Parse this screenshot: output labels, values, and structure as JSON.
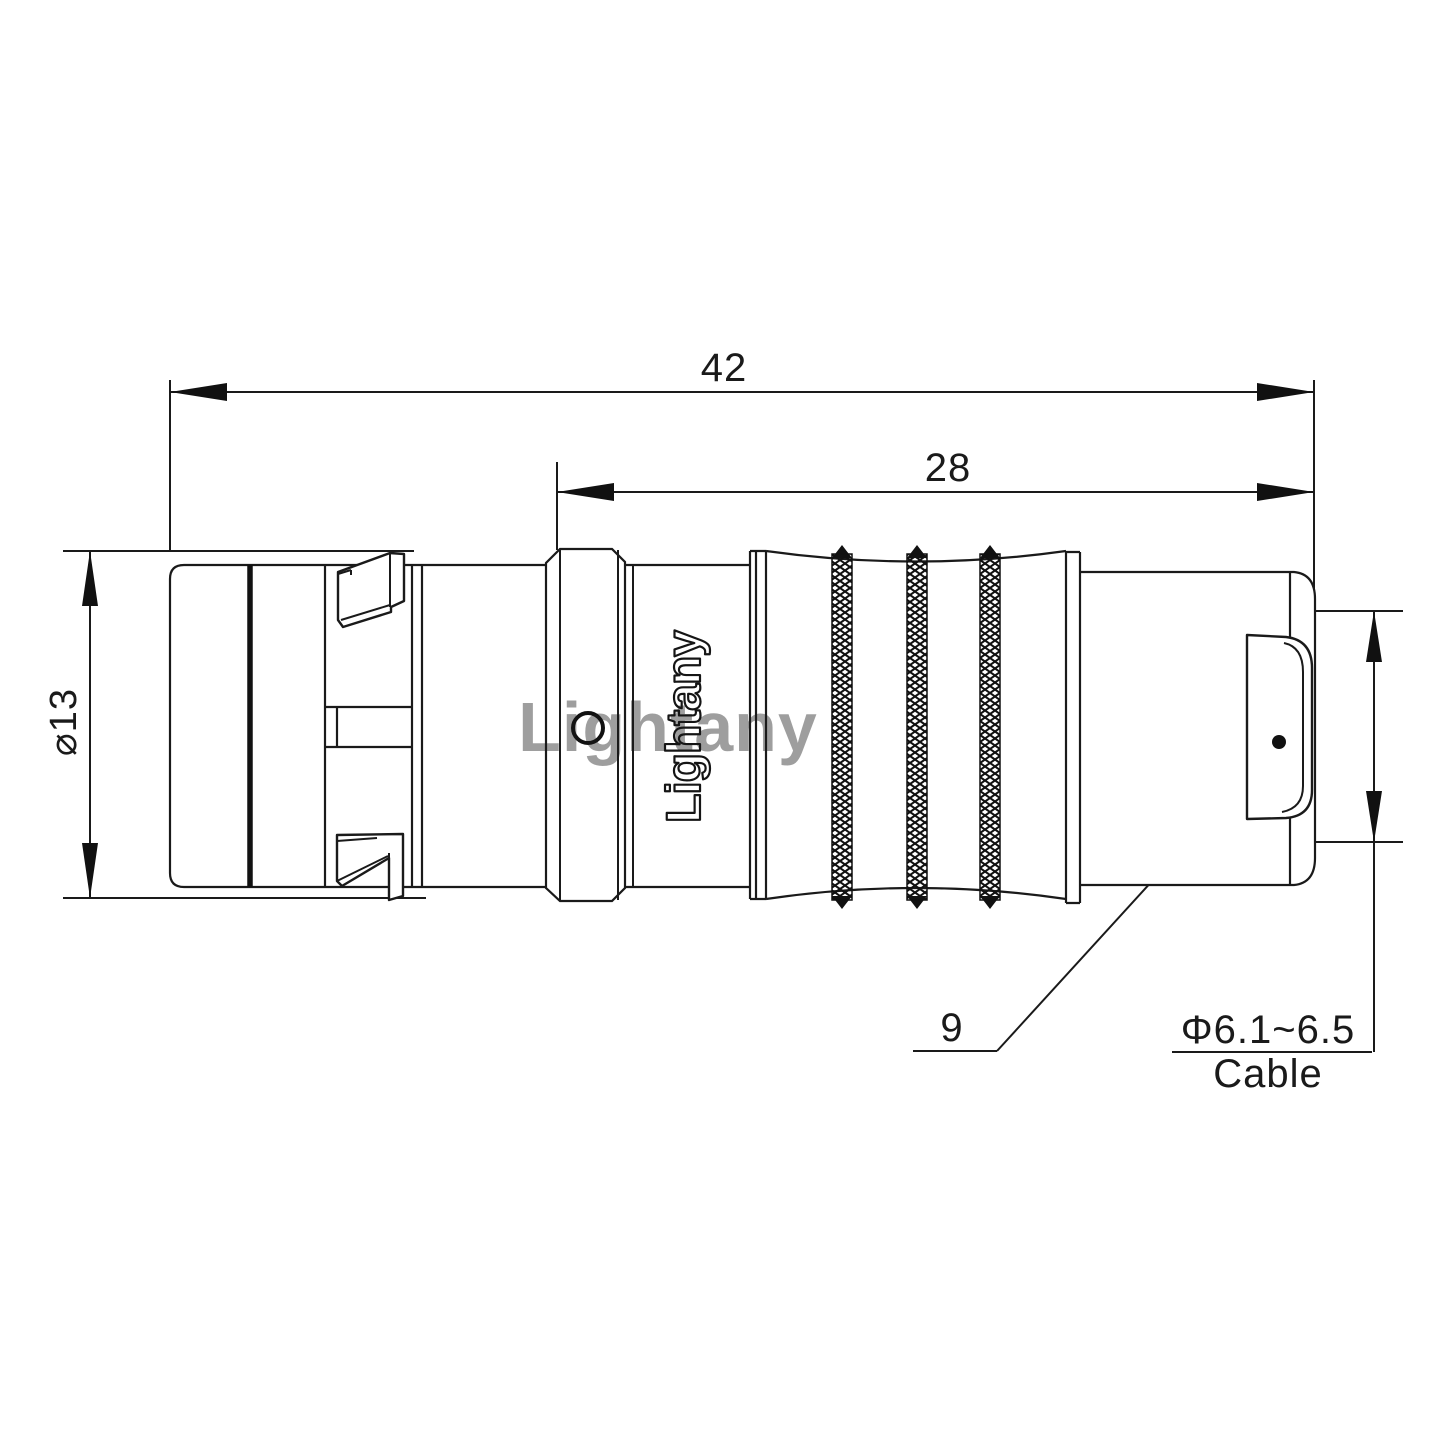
{
  "drawing": {
    "kind": "connector-outline-technical-drawing",
    "dimensions": {
      "overall_length": "42",
      "rear_length": "28",
      "shell_diameter": "⌀13",
      "bushing_number": "9",
      "cable_diameter": "Φ6.1~6.5",
      "cable_label": "Cable"
    },
    "branding": {
      "body_text": "Lightany",
      "watermark": "Lightany"
    },
    "colors": {
      "line": "#1a1a1a",
      "watermark": "#e8828c",
      "background": "#ffffff"
    }
  }
}
